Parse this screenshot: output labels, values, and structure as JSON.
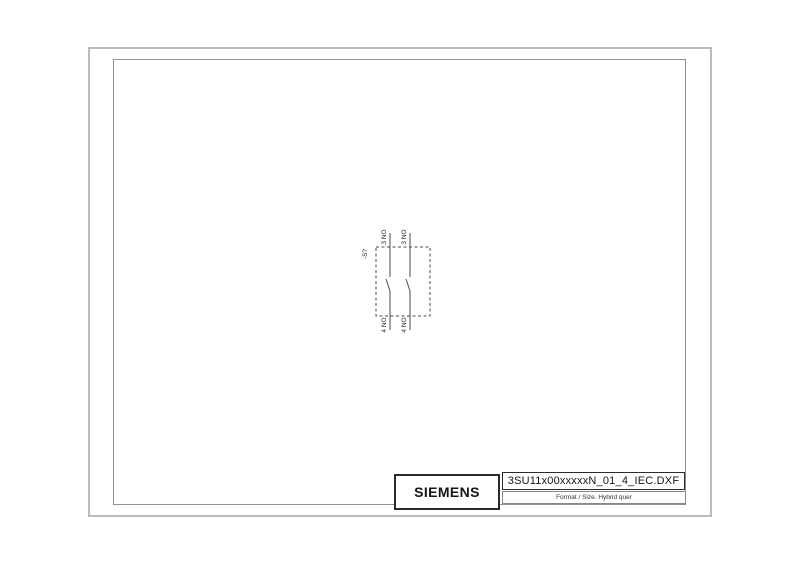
{
  "colors": {
    "frame_outer": "#b9bdbf",
    "frame_inner": "#8e9294",
    "schematic_line": "#4a4a4a",
    "text": "#1a1a1a"
  },
  "schematic": {
    "device_label": "-S?",
    "contacts": [
      {
        "top_label": "3 NO",
        "bottom_label": "4 NO"
      },
      {
        "top_label": "3 NO",
        "bottom_label": "4 NO"
      }
    ]
  },
  "title_block": {
    "brand": "SIEMENS",
    "filename": "3SU11x00xxxxxN_01_4_IEC.DXF",
    "format_info": "Format / Size. Hybrid quer"
  }
}
